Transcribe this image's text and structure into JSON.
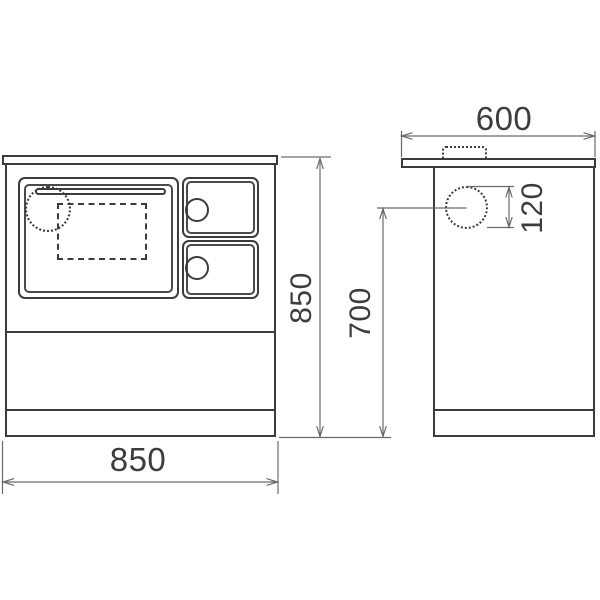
{
  "drawing": {
    "colors": {
      "outline": "#3c3c3c",
      "dimension_lines": "#6a6a6a",
      "label_text": "#3d3d3d",
      "background": "#ffffff"
    },
    "dims": {
      "front_width": "850",
      "front_height": "850",
      "depth": "600",
      "flue_center_height": "700",
      "flue_diameter": "120"
    }
  }
}
